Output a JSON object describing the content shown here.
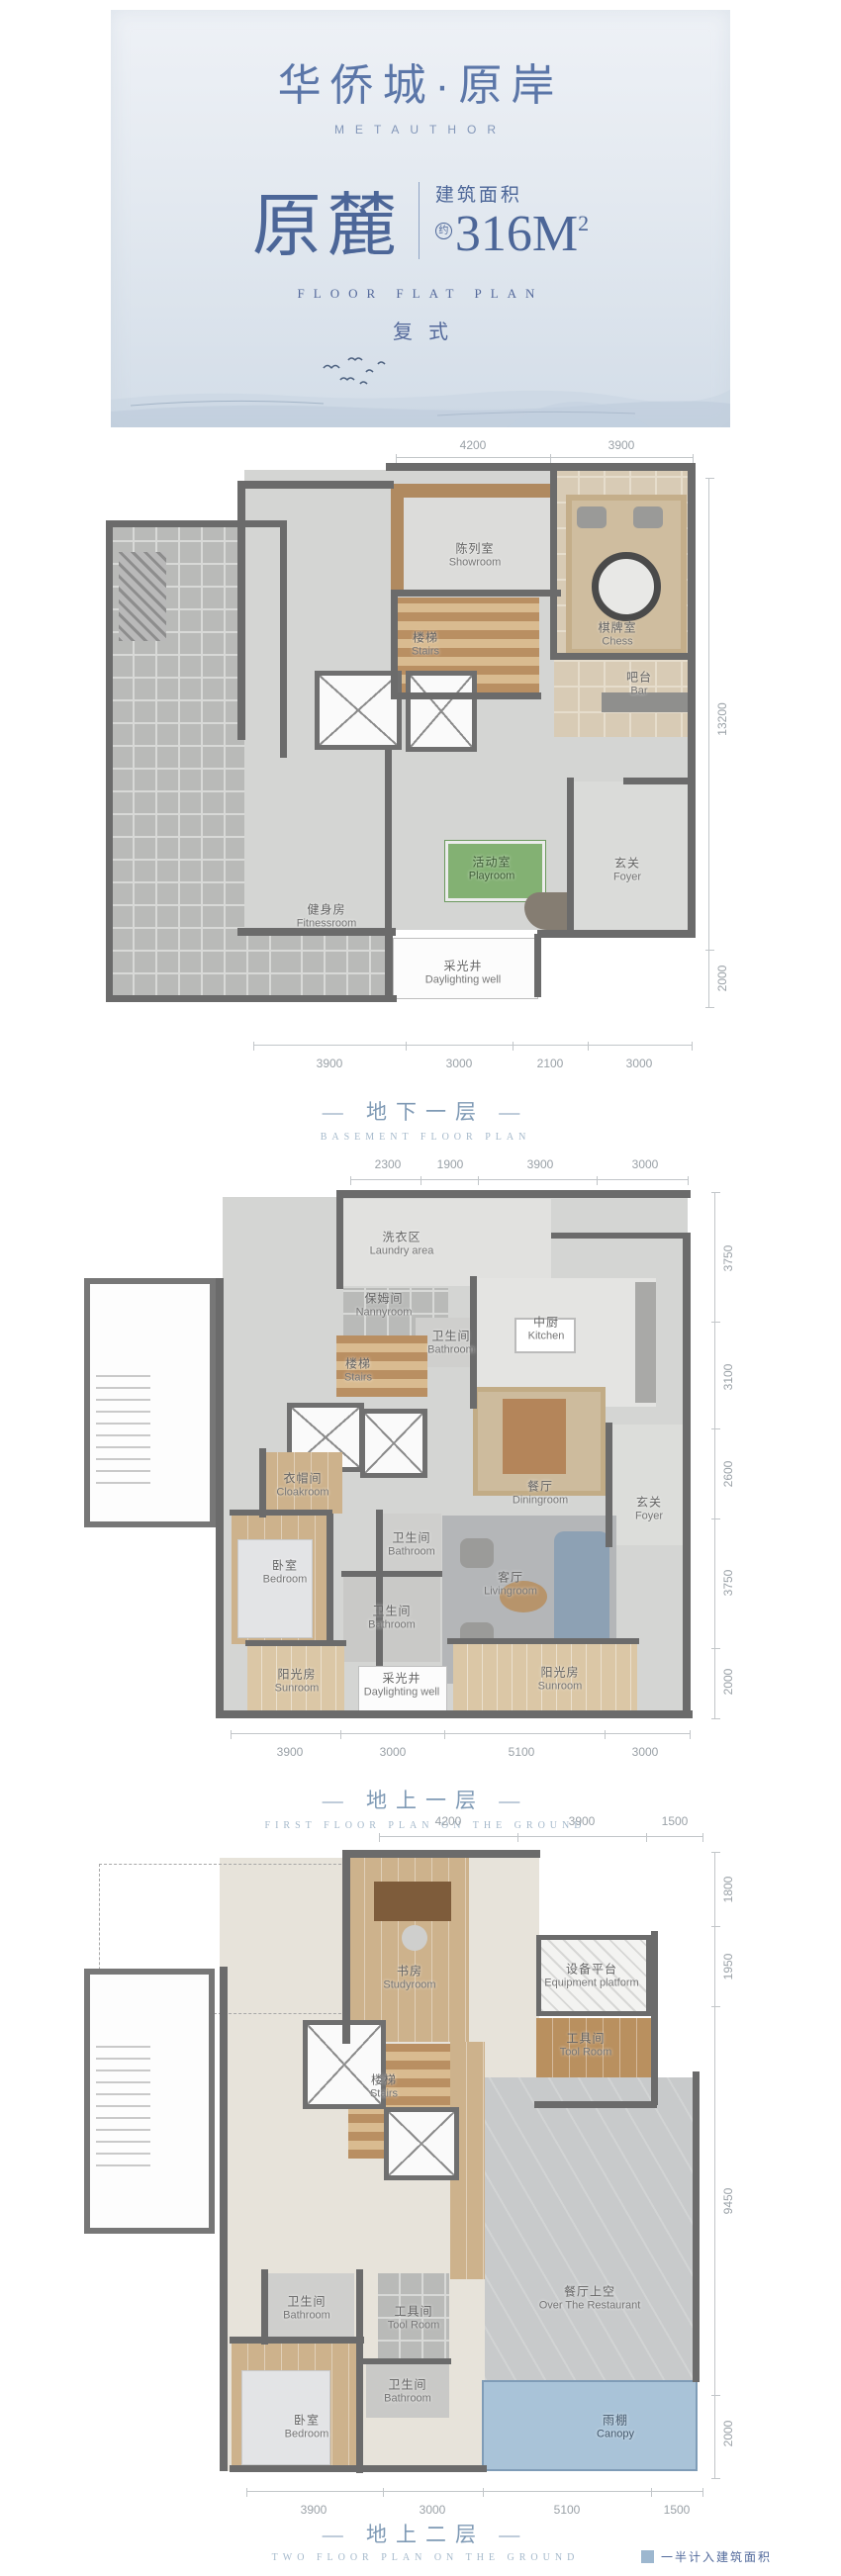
{
  "header": {
    "logo_cn": "华侨城·原岸",
    "logo_en": "METAUTHOR",
    "unit_name": "原麓",
    "area_label": "建筑面积",
    "area_approx": "约",
    "area_value": "316M",
    "area_sup": "2",
    "subtitle_en": "FLOOR FLAT PLAN",
    "subtitle_cn": "复式"
  },
  "plans": [
    {
      "title_cn": "— 地下一层 —",
      "title_en": "BASEMENT FLOOR PLAN",
      "dims_top": [
        "4200",
        "3900"
      ],
      "dims_right": [
        "13200",
        "2000"
      ],
      "dims_bottom": [
        "3900",
        "3000",
        "2100",
        "3000"
      ],
      "rooms": [
        {
          "cn": "陈列室",
          "en": "Showroom"
        },
        {
          "cn": "棋牌室",
          "en": "Chess"
        },
        {
          "cn": "楼梯",
          "en": "Stairs"
        },
        {
          "cn": "吧台",
          "en": "Bar"
        },
        {
          "cn": "健身房",
          "en": "Fitnessroom"
        },
        {
          "cn": "活动室",
          "en": "Playroom"
        },
        {
          "cn": "玄关",
          "en": "Foyer"
        },
        {
          "cn": "采光井",
          "en": "Daylighting well"
        }
      ]
    },
    {
      "title_cn": "— 地上一层 —",
      "title_en": "FIRST FLOOR PLAN ON THE GROUND",
      "dims_top": [
        "2300",
        "1900",
        "3900",
        "3000"
      ],
      "dims_right": [
        "3750",
        "3100",
        "2600",
        "3750",
        "2000"
      ],
      "dims_bottom": [
        "3900",
        "3000",
        "5100",
        "3000"
      ],
      "rooms": [
        {
          "cn": "洗衣区",
          "en": "Laundry area"
        },
        {
          "cn": "保姆间",
          "en": "Nannyroom"
        },
        {
          "cn": "卫生间",
          "en": "Bathroom"
        },
        {
          "cn": "中厨",
          "en": "Kitchen"
        },
        {
          "cn": "楼梯",
          "en": "Stairs"
        },
        {
          "cn": "餐厅",
          "en": "Diningroom"
        },
        {
          "cn": "玄关",
          "en": "Foyer"
        },
        {
          "cn": "衣帽间",
          "en": "Cloakroom"
        },
        {
          "cn": "卧室",
          "en": "Bedroom"
        },
        {
          "cn": "卫生间",
          "en": "Bathroom"
        },
        {
          "cn": "卫生间",
          "en": "Bathroom"
        },
        {
          "cn": "客厅",
          "en": "Livingroom"
        },
        {
          "cn": "阳光房",
          "en": "Sunroom"
        },
        {
          "cn": "采光井",
          "en": "Daylighting well"
        },
        {
          "cn": "阳光房",
          "en": "Sunroom"
        }
      ]
    },
    {
      "title_cn": "— 地上二层 —",
      "title_en": "TWO FLOOR PLAN ON THE GROUND",
      "dims_top": [
        "4200",
        "3900",
        "1500"
      ],
      "dims_right": [
        "1800",
        "1950",
        "9450",
        "2000"
      ],
      "dims_bottom": [
        "3900",
        "3000",
        "5100",
        "1500"
      ],
      "rooms": [
        {
          "cn": "书房",
          "en": "Studyroom"
        },
        {
          "cn": "设备平台",
          "en": "Equipment platform"
        },
        {
          "cn": "工具间",
          "en": "Tool Room"
        },
        {
          "cn": "楼梯",
          "en": "Stairs"
        },
        {
          "cn": "餐厅上空",
          "en": "Over The Restaurant"
        },
        {
          "cn": "卫生间",
          "en": "Bathroom"
        },
        {
          "cn": "工具间",
          "en": "Tool Room"
        },
        {
          "cn": "卫生间",
          "en": "Bathroom"
        },
        {
          "cn": "卧室",
          "en": "Bedroom"
        },
        {
          "cn": "雨棚",
          "en": "Canopy"
        }
      ]
    }
  ],
  "footer": {
    "legend_note": "一半计入建筑面积"
  },
  "colors": {
    "brand_blue": "#4c6698",
    "section_title_blue": "#7f9ab5",
    "dim_grey": "#9aa1a7",
    "wall_grey": "#6b6b6b",
    "playroom_green": "#83b173",
    "canopy_blue": "#a9c3d8"
  }
}
